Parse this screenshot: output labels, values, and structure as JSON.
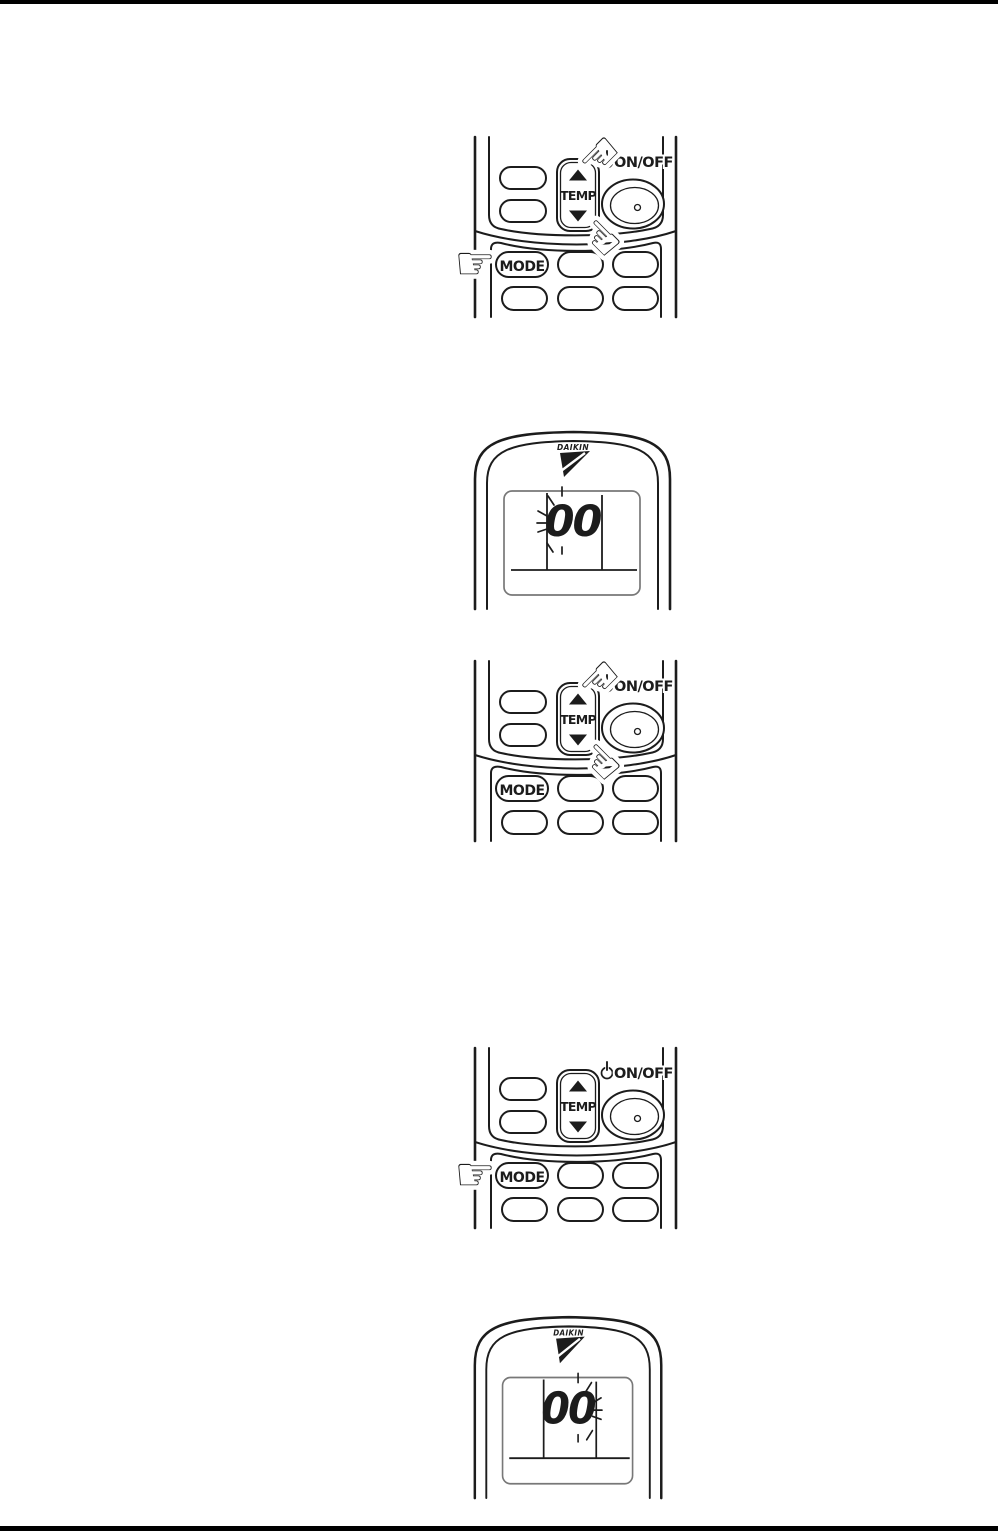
{
  "page": {
    "width": 998,
    "height": 1531,
    "kind": "instruction-manual-page"
  },
  "colors": {
    "paper": "#ffffff",
    "ink": "#1c1c1c",
    "rule": "#000000",
    "display-border": "#787878"
  },
  "labels": {
    "temp": "TEMP",
    "on_off": "ON/OFF",
    "mode": "MODE",
    "brand": "DAIKIN"
  },
  "figures": [
    {
      "id": "remote-buttons-step-1",
      "type": "remote-buttons-closeup",
      "hands_pointing_at": [
        "temp-up-button",
        "temp-down-button",
        "mode-button"
      ]
    },
    {
      "id": "remote-display-blink-left",
      "type": "remote-display-closeup",
      "value": "00",
      "blink_side": "left"
    },
    {
      "id": "remote-buttons-step-2",
      "type": "remote-buttons-closeup",
      "hands_pointing_at": [
        "temp-up-button",
        "temp-down-button"
      ]
    },
    {
      "id": "remote-buttons-step-3",
      "type": "remote-buttons-closeup",
      "hands_pointing_at": [
        "mode-button"
      ]
    },
    {
      "id": "remote-display-blink-right",
      "type": "remote-display-closeup",
      "value": "00",
      "blink_side": "right"
    }
  ]
}
